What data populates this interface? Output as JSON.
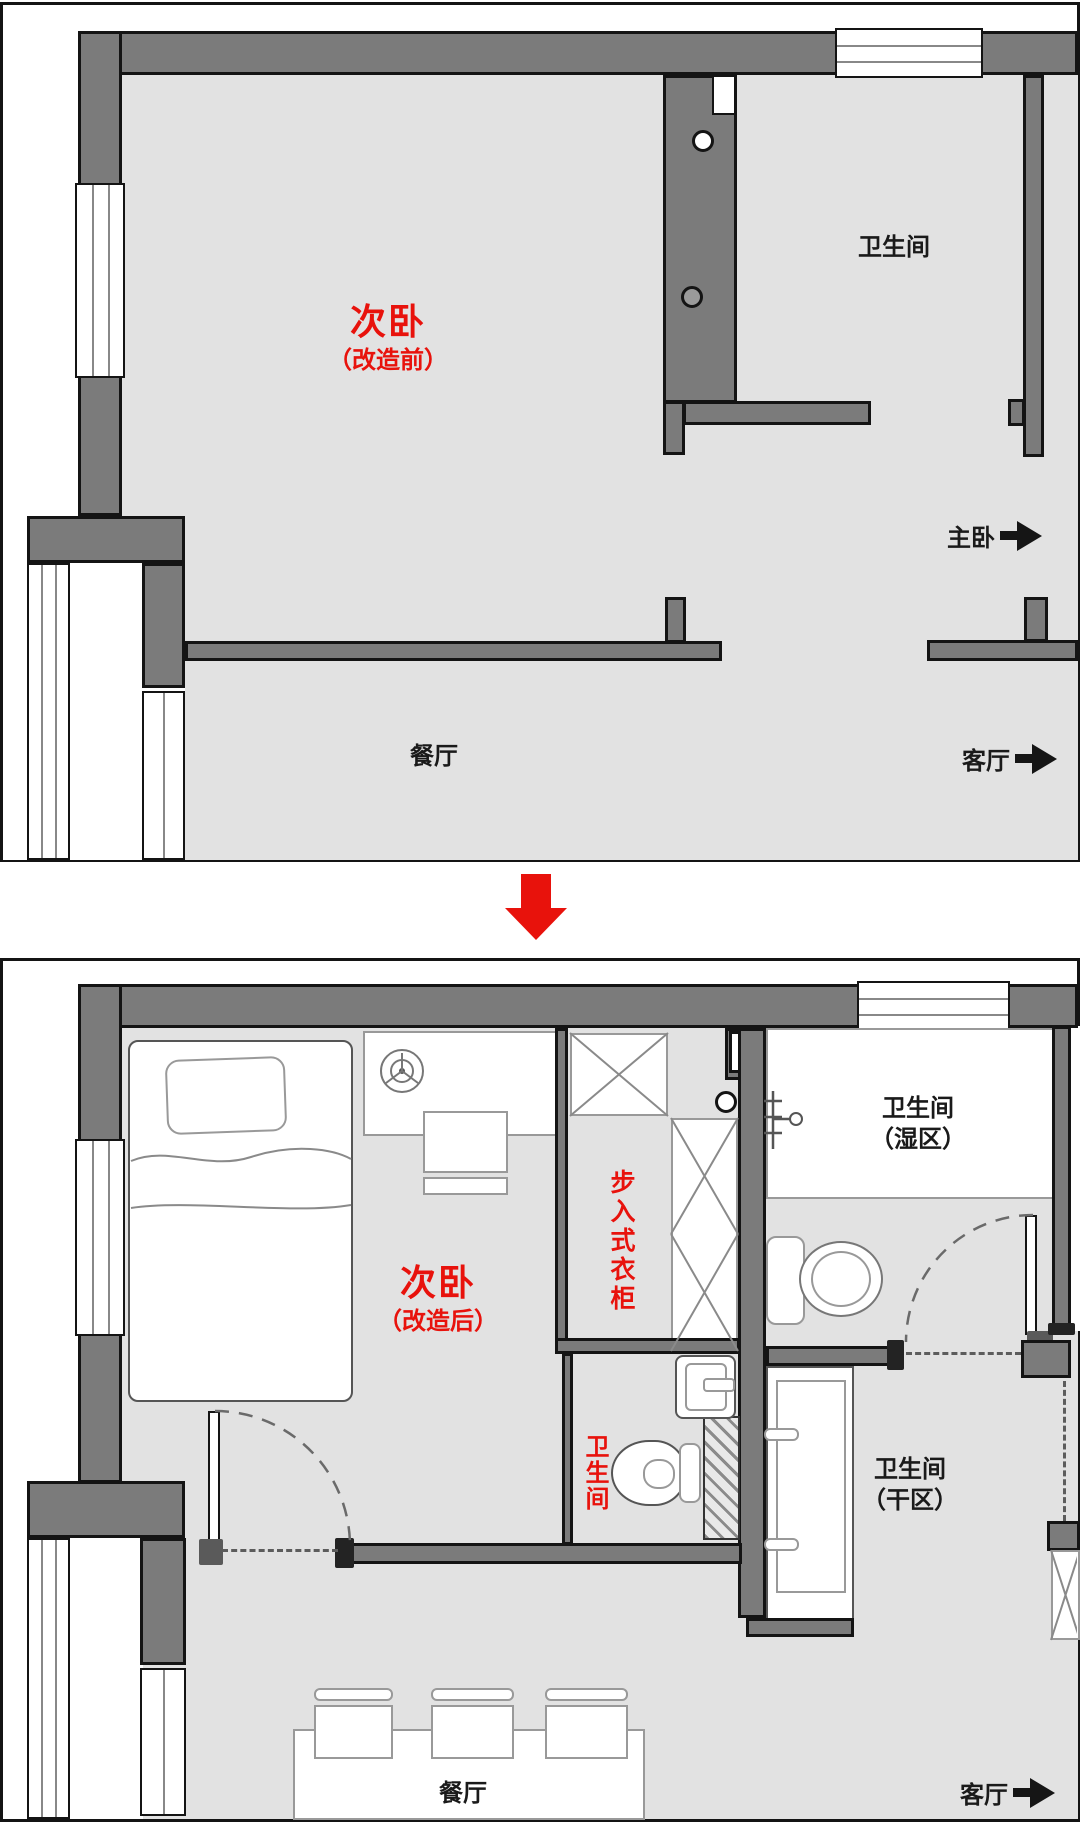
{
  "colors": {
    "wall": "#7b7b7b",
    "outline": "#141414",
    "floor": "#e2e2e2",
    "accent_red": "#e8120c"
  },
  "plan_before": {
    "room_title": "次卧",
    "room_subtitle": "（改造前）",
    "bathroom_label": "卫生间",
    "master_label": "主卧",
    "dining_label": "餐厅",
    "living_label": "客厅"
  },
  "plan_after": {
    "room_title": "次卧",
    "room_subtitle": "（改造后）",
    "closet_label": "步入式衣柜",
    "wet_bathroom_line1": "卫生间",
    "wet_bathroom_line2": "（湿区）",
    "small_bathroom_label": "卫生间",
    "dry_bathroom_line1": "卫生间",
    "dry_bathroom_line2": "（干区）",
    "dining_label": "餐厅",
    "living_label": "客厅"
  }
}
